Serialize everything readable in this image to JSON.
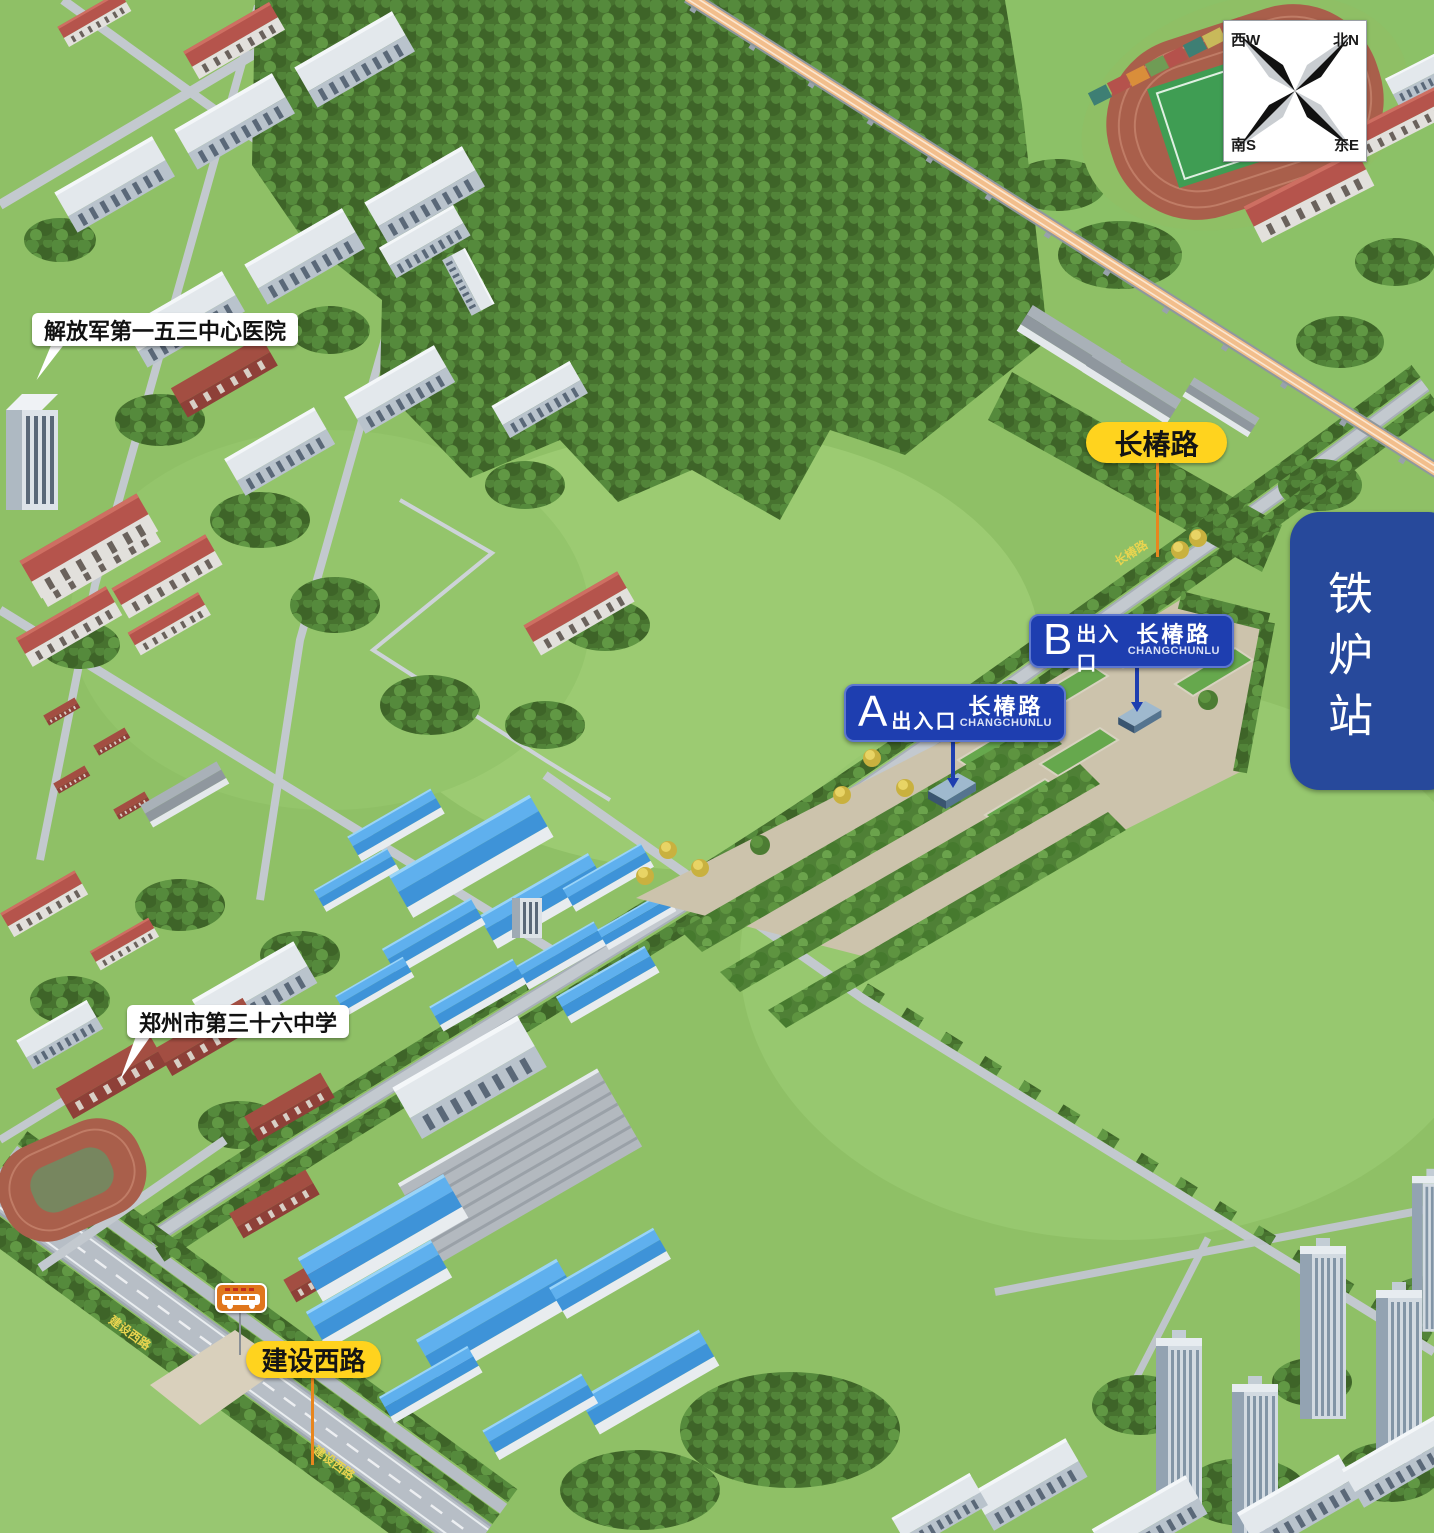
{
  "station_badge": {
    "text": "铁炉站"
  },
  "compass": {
    "top_left": "西W",
    "top_right": "北N",
    "bottom_left": "南S",
    "bottom_right": "东E"
  },
  "road_labels": {
    "changchunlu": "长椿路",
    "jianshexilu": "建设西路"
  },
  "painted_road_names": {
    "changchunlu": "长椿路",
    "jianshexilu": "建设西路"
  },
  "exits": [
    {
      "letter": "A",
      "entrance_word": "出入口",
      "road_cn": "长椿路",
      "road_pinyin": "CHANGCHUNLU"
    },
    {
      "letter": "B",
      "entrance_word": "出入口",
      "road_cn": "长椿路",
      "road_pinyin": "CHANGCHUNLU"
    }
  ],
  "pois": {
    "hospital": "解放军第一五三中心医院",
    "school": "郑州市第三十六中学"
  },
  "colors": {
    "label_yellow": "#FFD31E",
    "leader_orange": "#E8861E",
    "exit_blue": "#1E3EB0",
    "station_badge_blue": "#27499B",
    "field_green": "#8FC066",
    "forest_green": "#47722F",
    "road_gray": "#C3C9CF",
    "railway_deck": "#F2BE8C",
    "blue_roof": "#3E93D8",
    "red_roof": "#B5544C",
    "track_red": "#A95F4B",
    "bus_sign_orange": "#E0761C"
  }
}
